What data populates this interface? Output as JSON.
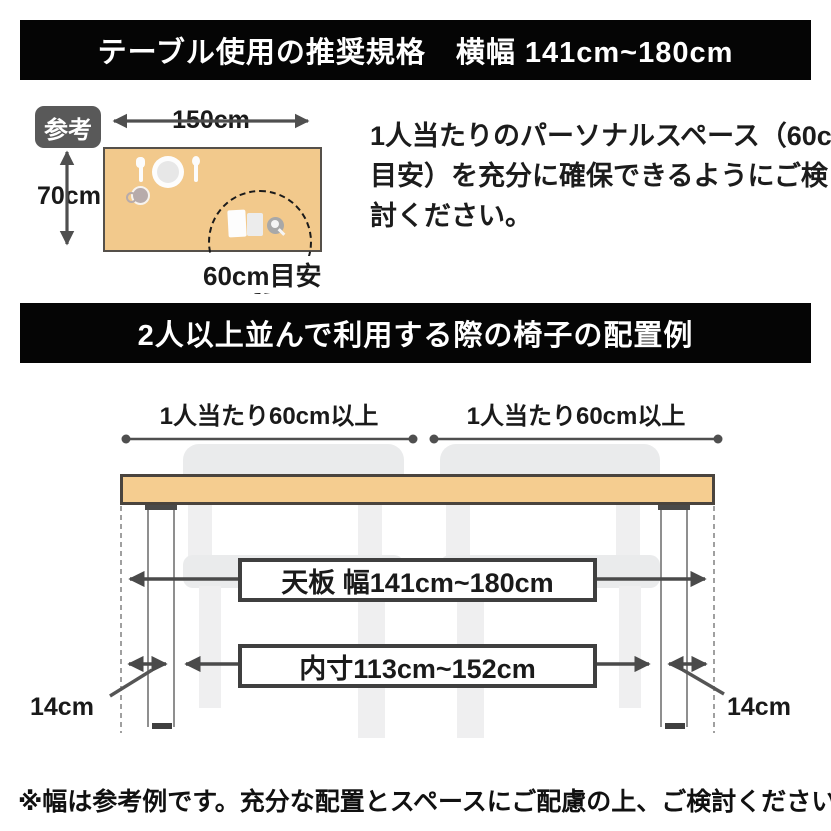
{
  "banners": {
    "top": "テーブル使用の推奨規格　横幅 141cm~180cm",
    "middle": "2人以上並んで利用する際の椅子の配置例"
  },
  "reference": {
    "badge": "参考",
    "table_width": "150cm",
    "table_depth": "70cm",
    "personal_space": "60cm目安",
    "description_lines": [
      "1人当たりのパーソナルスペース（60cm",
      "目安）を充分に確保できるようにご検",
      "討ください。"
    ]
  },
  "layout_example": {
    "per_person_left": "1人当たり60cm以上",
    "per_person_right": "1人当たり60cm以上",
    "tabletop_width": "天板 幅141cm~180cm",
    "inner_width": "内寸113cm~152cm",
    "leg_offset_left": "14cm",
    "leg_offset_right": "14cm"
  },
  "footnote": "※幅は参考例です。充分な配置とスペースにご配慮の上、ご検討ください。",
  "colors": {
    "banner_bg": "#050505",
    "banner_text": "#ffffff",
    "table_fill_small": "#F2C98C",
    "tabletop_fill": "#F5CD90",
    "outline_dark": "#4a4a4a",
    "chair_gray": "#eaebec",
    "badge_bg": "#595959",
    "arrow_gray": "#4f4f4f"
  }
}
